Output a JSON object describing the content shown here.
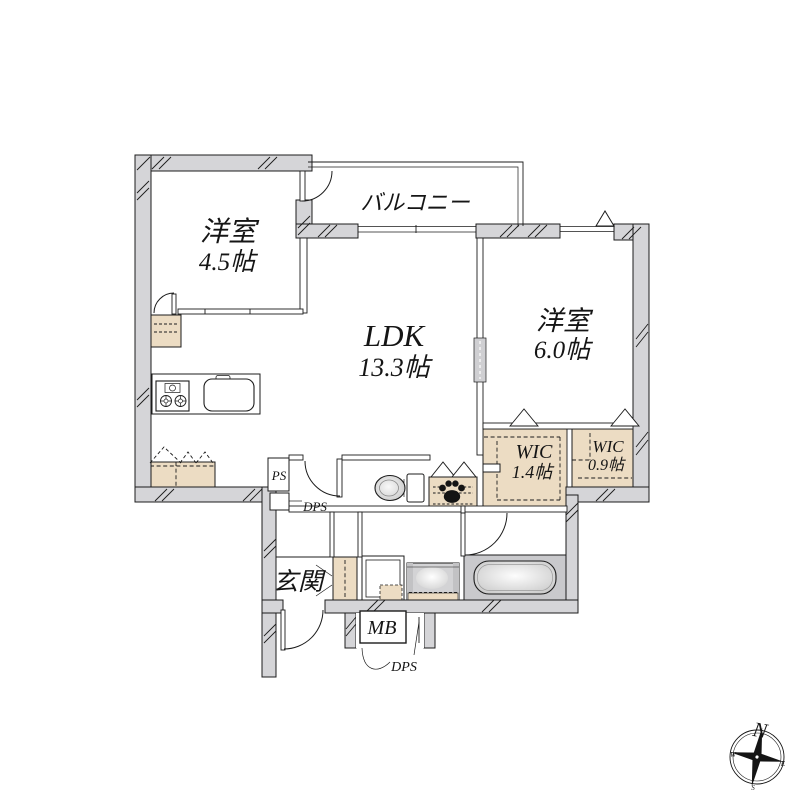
{
  "rooms": {
    "west45": {
      "label": "洋室",
      "size": "4.5帖"
    },
    "balcony": {
      "label": "バルコニー"
    },
    "ldk": {
      "label": "LDK",
      "size": "13.3帖"
    },
    "west60": {
      "label": "洋室",
      "size": "6.0帖"
    },
    "wic14": {
      "label": "WIC",
      "size": "1.4帖"
    },
    "wic09": {
      "label": "WIC",
      "size": "0.9帖"
    },
    "genkan": {
      "label": "玄関"
    }
  },
  "annotations": {
    "ps": "PS",
    "dps_side": "DPS",
    "mb": "MB",
    "dps_bottom": "DPS"
  },
  "compass": {
    "north": "N",
    "west": "W",
    "east": "E",
    "south": "S"
  },
  "colors": {
    "wall": "#d5d5d8",
    "storage_beige": "#ecdcc3",
    "bath_gray": "#c9c9cc",
    "line": "#1c1c1c"
  }
}
